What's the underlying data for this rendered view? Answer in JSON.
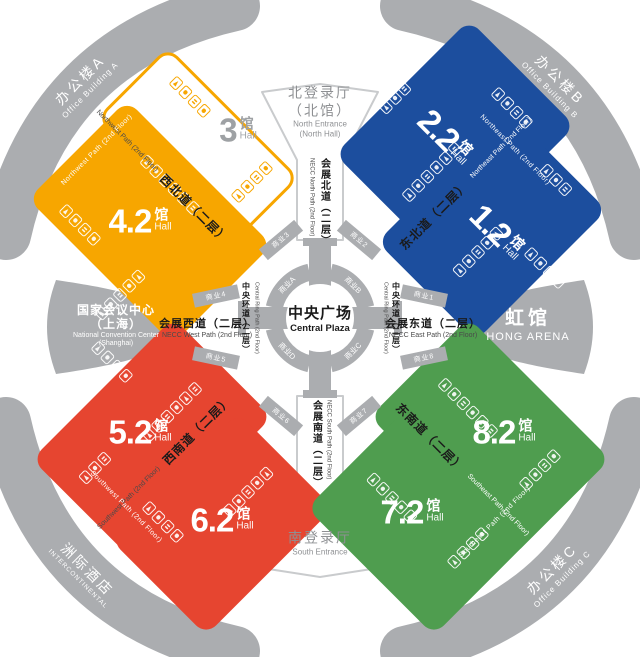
{
  "colors": {
    "orange": "#F7A600",
    "blue": "#1C4E9E",
    "red": "#E64530",
    "green": "#4F9D4F",
    "gray": "#ABADB0"
  },
  "halls": [
    {
      "num": "3",
      "unit": "馆",
      "en": "Hall"
    },
    {
      "num": "4.2",
      "unit": "馆",
      "en": "Hall"
    },
    {
      "num": "2.2",
      "unit": "馆",
      "en": "Hall"
    },
    {
      "num": "1.2",
      "unit": "馆",
      "en": "Hall"
    },
    {
      "num": "5.2",
      "unit": "馆",
      "en": "Hall"
    },
    {
      "num": "6.2",
      "unit": "馆",
      "en": "Hall"
    },
    {
      "num": "8.2",
      "unit": "馆",
      "en": "Hall"
    },
    {
      "num": "7.2",
      "unit": "馆",
      "en": "Hall"
    }
  ],
  "entrances": {
    "north": {
      "zh": "北登录厅",
      "zh2": "（北馆）",
      "en": "North Entrance",
      "en2": "(North Hall)"
    },
    "south": {
      "zh": "南登录厅",
      "en": "South Entrance"
    }
  },
  "wings": {
    "west": {
      "zh": "国家会议中心",
      "zh2": "（上海）",
      "en": "National Convention Center",
      "en2": "(Shanghai)"
    },
    "east": {
      "zh": "虹馆",
      "en": "HONG ARENA"
    }
  },
  "corners": {
    "office_a": {
      "zh": "办公楼A",
      "en": "Office Building A"
    },
    "office_b": {
      "zh": "办公楼B",
      "en": "Office Building B"
    },
    "office_c": {
      "zh": "办公楼C",
      "en": "Office Building C"
    },
    "hotel": {
      "zh": "洲际酒店",
      "en": "INTERCONTINENTAL"
    }
  },
  "plaza": {
    "zh": "中央广场",
    "en": "Central Plaza"
  },
  "ring_zones": [
    "商业A",
    "商业B",
    "商业C",
    "商业D"
  ],
  "connectors": [
    "商业1",
    "商业2",
    "商业3",
    "商业4",
    "商业5",
    "商业6",
    "商业7",
    "商业8"
  ],
  "paths": {
    "north": {
      "zh": "会展北道（二层）",
      "en": "NECC North Path (2nd Floor)"
    },
    "south": {
      "zh": "会展南道（二层）",
      "en": "NECC South Path (2nd Floor)"
    },
    "west": {
      "zh": "会展西道（二层）",
      "en": "NECC West Path (2nd Floor)"
    },
    "east": {
      "zh": "会展东道（二层）",
      "en": "NECC East Path (2nd Floor)"
    },
    "ring": {
      "zh": "中央环道（二层）",
      "en": "Central Ring Path (2nd Floor)"
    },
    "nw": {
      "zh": "西北道（二层）",
      "en": "Northwest Path (2nd Floor)"
    },
    "ne": {
      "zh": "东北道（二层）",
      "en": "Northeast Path (2nd Floor)"
    },
    "sw": {
      "zh": "西南道（二层）",
      "en": "Southwest Path (2nd Floor)"
    },
    "se": {
      "zh": "东南道（二层）",
      "en": "Southeast Path (2nd Floor)"
    }
  }
}
